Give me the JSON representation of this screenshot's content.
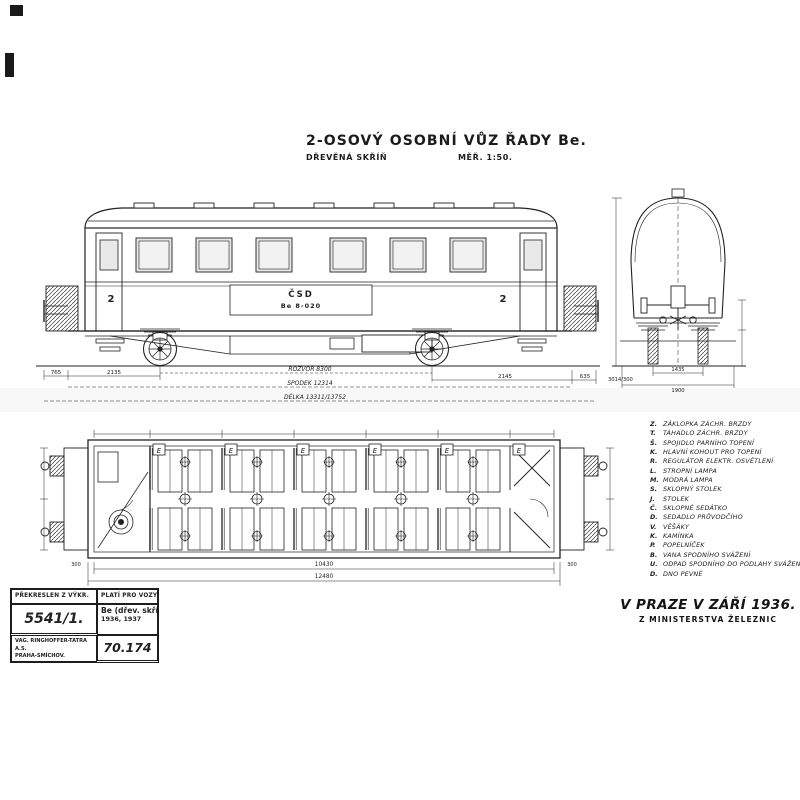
{
  "ink": "#222222",
  "title": {
    "main": "2-OSOVÝ OSOBNÍ VŮZ ŘADY Be.",
    "sub_left": "DŘEVĚNÁ SKŘÍŇ",
    "sub_right": "MĚŘ. 1:50."
  },
  "side_view": {
    "class_left": "2",
    "class_right": "2",
    "owner": "ČSD",
    "car_number": "Be 8-020",
    "dims": {
      "left_a": "765",
      "left_b": "2135",
      "right_a": "2145",
      "right_b": "635",
      "wheelbase": "ROZVOR 8300",
      "underframe": "SPODEK 12314",
      "length": "DÉLKA 13311/13752"
    }
  },
  "end_view": {
    "dims": {
      "left": "3014/300",
      "gauge": "1435",
      "width": "1900"
    }
  },
  "plan_view": {
    "vent_label": "E",
    "dims": {
      "inner": "10430",
      "overall": "12480",
      "end_left": "300",
      "end_right": "300"
    }
  },
  "legend": {
    "items": [
      {
        "key": "Z.",
        "label": "ZÁKLOPKA ZÁCHR. BRZDY"
      },
      {
        "key": "T.",
        "label": "TÁHADLO ZÁCHR. BRZDY"
      },
      {
        "key": "Š.",
        "label": "SPOJIDLO PARNÍHO TOPENÍ"
      },
      {
        "key": "K.",
        "label": "HLAVNÍ KOHOUT PRO TOPENÍ"
      },
      {
        "key": "R.",
        "label": "REGULÁTOR ELEKTR. OSVĚTLENÍ"
      },
      {
        "key": "L.",
        "label": "STROPNÍ LAMPA"
      },
      {
        "key": "M.",
        "label": "MODRÁ LAMPA"
      },
      {
        "key": "S.",
        "label": "SKLOPNÝ STOLEK"
      },
      {
        "key": "J.",
        "label": "STOLEK"
      },
      {
        "key": "Č.",
        "label": "SKLOPNÉ SEDÁTKO"
      },
      {
        "key": "D.",
        "label": "SEDADLO PRŮVODČÍHO"
      },
      {
        "key": "V.",
        "label": "VĚŠÁKY"
      },
      {
        "key": "K.",
        "label": "KAMÍNKA"
      },
      {
        "key": "P.",
        "label": "POPELNÍČEK"
      },
      {
        "key": "B.",
        "label": "VANA SPODNÍHO SVÁŽENÍ"
      },
      {
        "key": "U.",
        "label": "ODPAD SPODNÍHO DO PODLAHY SVÁŽENÍ"
      },
      {
        "key": "D.",
        "label": "DNO PEVNÉ"
      }
    ]
  },
  "footer": {
    "place_date": "V PRAZE V ZÁŘÍ 1936.",
    "issuer": "Z MINISTERSTVA ŽELEZNIC"
  },
  "title_block": {
    "r1c1": "PŘEKRESLEN Z VÝKR.",
    "r1c2": "PLATÍ PRO VOZY:",
    "drawing_no": "5541/1.",
    "series": "Be (dřev. skříň)",
    "years": "1936, 1937",
    "maker_1": "VAG. RINGHOFFER-TATRA A.S.",
    "maker_2": "PRAHA-SMÍCHOV.",
    "file_no": "70.174"
  }
}
